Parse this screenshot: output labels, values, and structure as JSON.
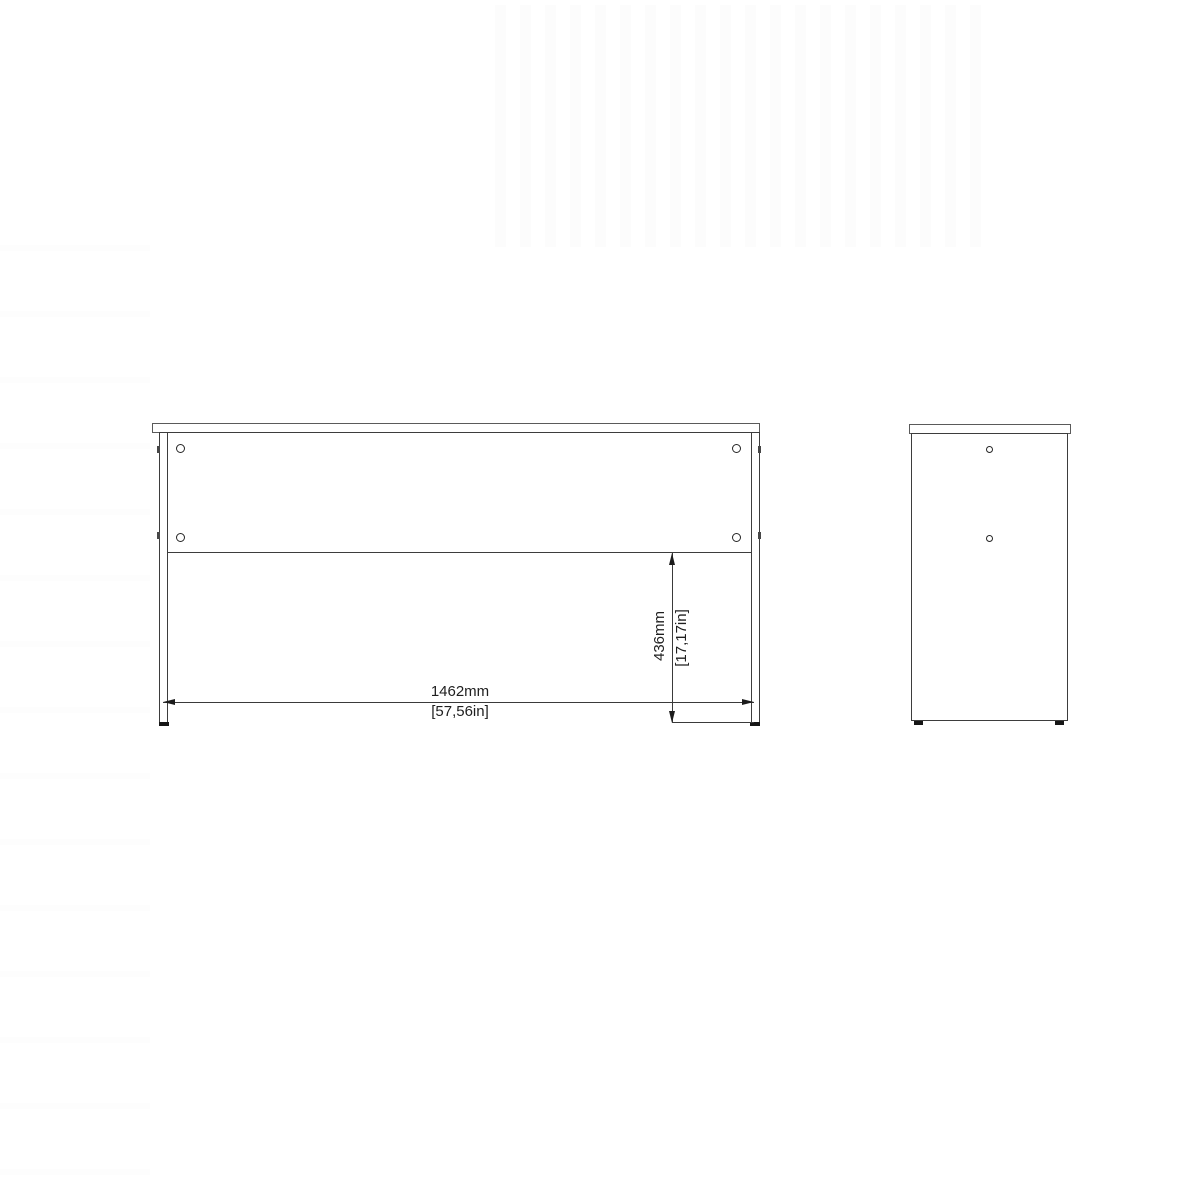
{
  "drawing": {
    "type": "furniture-technical-drawing",
    "background": "#ffffff",
    "line_color": "#3d3d3d",
    "text_color": "#1f1f1f",
    "views": [
      {
        "id": "front-elevation",
        "description": "rear/front elevation of desk with two legs, top panel and back rail with four cam holes"
      },
      {
        "id": "side-elevation",
        "description": "side elevation of desk panel with two cam holes"
      }
    ],
    "dimensions": {
      "width": {
        "mm": "1462mm",
        "inches": "[57,56in]"
      },
      "height": {
        "mm": "436mm",
        "inches": "[17,17in]"
      }
    }
  }
}
